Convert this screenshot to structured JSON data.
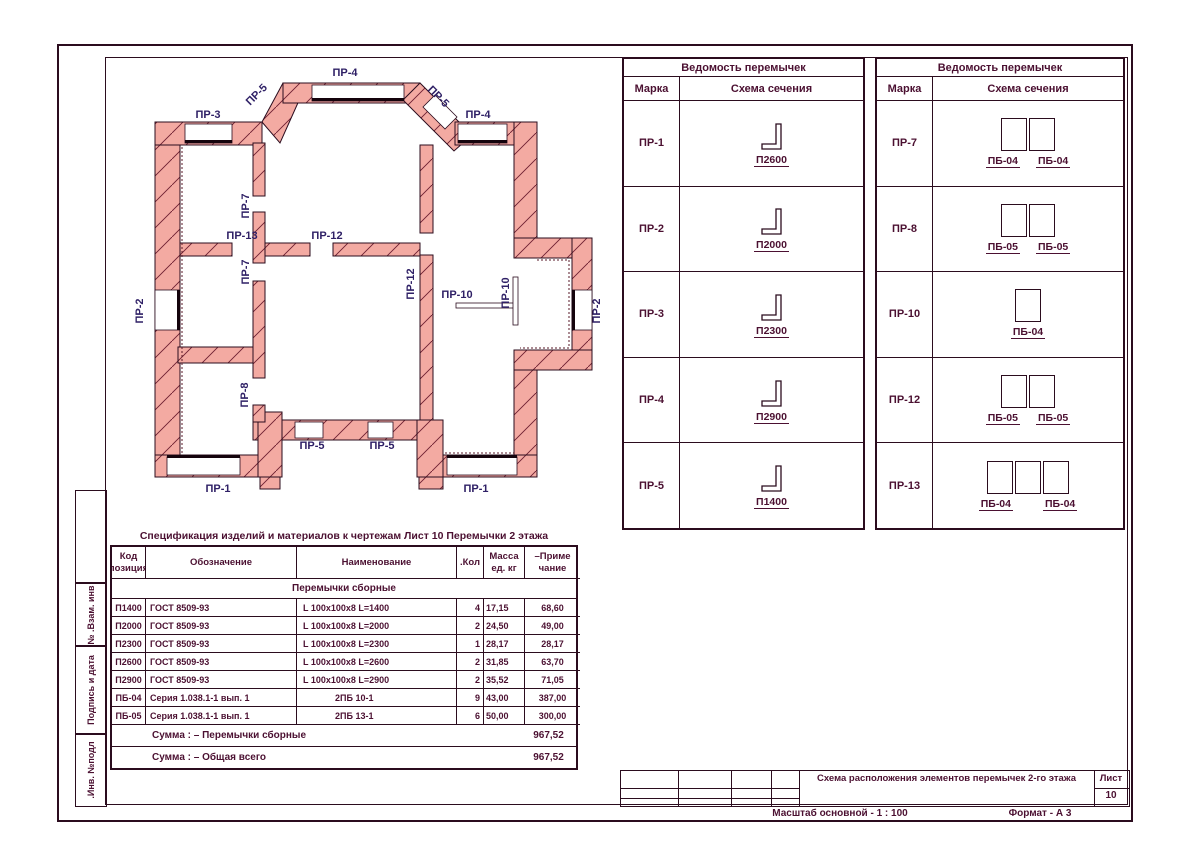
{
  "sheet": {
    "scale_note": "Масштаб основной - 1 : 100",
    "format_note": "Формат - А 3",
    "title_block": {
      "title": "Схема расположения элементов перемычек 2-го этажа",
      "sheet_label": "Лист",
      "sheet_number": "10"
    },
    "sidebar_labels": [
      "№ .Взам. инв",
      "Подпись и дата",
      ".Инв. №подл"
    ]
  },
  "plan": {
    "labels": [
      {
        "t": "ПР-4",
        "x": 225,
        "y": 21,
        "r": 0
      },
      {
        "t": "ПР-5",
        "x": 139,
        "y": 42,
        "r": -45
      },
      {
        "t": "ПР-5",
        "x": 316,
        "y": 44,
        "r": 45
      },
      {
        "t": "ПР-3",
        "x": 88,
        "y": 63,
        "r": 0
      },
      {
        "t": "ПР-4",
        "x": 358,
        "y": 63,
        "r": 0
      },
      {
        "t": "ПР-7",
        "x": 129,
        "y": 151,
        "r": -90
      },
      {
        "t": "ПР-13",
        "x": 122,
        "y": 184,
        "r": 0
      },
      {
        "t": "ПР-12",
        "x": 207,
        "y": 184,
        "r": 0
      },
      {
        "t": "ПР-7",
        "x": 129,
        "y": 217,
        "r": -90
      },
      {
        "t": "ПР-2",
        "x": 23,
        "y": 256,
        "r": -90
      },
      {
        "t": "ПР-12",
        "x": 294,
        "y": 229,
        "r": -90
      },
      {
        "t": "ПР-10",
        "x": 337,
        "y": 243,
        "r": 0
      },
      {
        "t": "ПР-10",
        "x": 389,
        "y": 238,
        "r": -90
      },
      {
        "t": "ПР-2",
        "x": 480,
        "y": 256,
        "r": -90
      },
      {
        "t": "ПР-8",
        "x": 128,
        "y": 340,
        "r": -90
      },
      {
        "t": "ПР-5",
        "x": 192,
        "y": 394,
        "r": 0
      },
      {
        "t": "ПР-5",
        "x": 262,
        "y": 394,
        "r": 0
      },
      {
        "t": "ПР-1",
        "x": 98,
        "y": 437,
        "r": 0
      },
      {
        "t": "ПР-1",
        "x": 356,
        "y": 437,
        "r": 0
      }
    ]
  },
  "lintel_tables": [
    {
      "title": "Ведомость перемычек",
      "col_mark": "Марка",
      "col_schema": "Схема сечения",
      "rows": [
        {
          "mark": "ПР-1",
          "type": "angle",
          "labels": [
            "П2600"
          ]
        },
        {
          "mark": "ПР-2",
          "type": "angle",
          "labels": [
            "П2000"
          ]
        },
        {
          "mark": "ПР-3",
          "type": "angle",
          "labels": [
            "П2300"
          ]
        },
        {
          "mark": "ПР-4",
          "type": "angle",
          "labels": [
            "П2900"
          ]
        },
        {
          "mark": "ПР-5",
          "type": "angle",
          "labels": [
            "П1400"
          ]
        }
      ]
    },
    {
      "title": "Ведомость перемычек",
      "col_mark": "Марка",
      "col_schema": "Схема сечения",
      "rows": [
        {
          "mark": "ПР-7",
          "type": "blocks",
          "count": 2,
          "labels": [
            "ПБ-04",
            "ПБ-04"
          ]
        },
        {
          "mark": "ПР-8",
          "type": "blocks",
          "count": 2,
          "labels": [
            "ПБ-05",
            "ПБ-05"
          ]
        },
        {
          "mark": "ПР-10",
          "type": "blocks",
          "count": 1,
          "labels": [
            "ПБ-04"
          ]
        },
        {
          "mark": "ПР-12",
          "type": "blocks",
          "count": 2,
          "labels": [
            "ПБ-05",
            "ПБ-05"
          ]
        },
        {
          "mark": "ПР-13",
          "type": "blocks",
          "count": 3,
          "labels": [
            "ПБ-04",
            "ПБ-04"
          ]
        }
      ]
    }
  ],
  "spec_table": {
    "title": "Спецификация изделий и материалов к чертежам  Лист 10  Перемычки 2 этажа",
    "headers": {
      "code1": "Код",
      "code2": "позиция",
      "designation": "Обозначение",
      "name": "Наименование",
      "qty": ".Кол",
      "mass1": "Масса",
      "mass2": "ед. кг",
      "note1": "–Приме",
      "note2": "чание"
    },
    "section": "Перемычки сборные",
    "rows": [
      {
        "code": "П1400",
        "designation": "ГОСТ 8509-93",
        "name": "L 100x100x8  L=1400",
        "qty": "4",
        "mass": "17,15",
        "note": "68,60",
        "indent": false
      },
      {
        "code": "П2000",
        "designation": "ГОСТ 8509-93",
        "name": "L 100x100x8  L=2000",
        "qty": "2",
        "mass": "24,50",
        "note": "49,00",
        "indent": false
      },
      {
        "code": "П2300",
        "designation": "ГОСТ 8509-93",
        "name": "L 100x100x8  L=2300",
        "qty": "1",
        "mass": "28,17",
        "note": "28,17",
        "indent": false
      },
      {
        "code": "П2600",
        "designation": "ГОСТ 8509-93",
        "name": "L 100x100x8  L=2600",
        "qty": "2",
        "mass": "31,85",
        "note": "63,70",
        "indent": false
      },
      {
        "code": "П2900",
        "designation": "ГОСТ 8509-93",
        "name": "L 100x100x8  L=2900",
        "qty": "2",
        "mass": "35,52",
        "note": "71,05",
        "indent": false
      },
      {
        "code": "ПБ-04",
        "designation": "Серия 1.038.1-1 вып. 1",
        "name": "2ПБ 10-1",
        "qty": "9",
        "mass": "43,00",
        "note": "387,00",
        "indent": true
      },
      {
        "code": "ПБ-05",
        "designation": "Серия 1.038.1-1 вып. 1",
        "name": "2ПБ 13-1",
        "qty": "6",
        "mass": "50,00",
        "note": "300,00",
        "indent": true
      }
    ],
    "sums": [
      {
        "label": "Сумма : – Перемычки сборные",
        "value": "967,52"
      },
      {
        "label": "Сумма : – Общая всего",
        "value": "967,52"
      }
    ]
  }
}
